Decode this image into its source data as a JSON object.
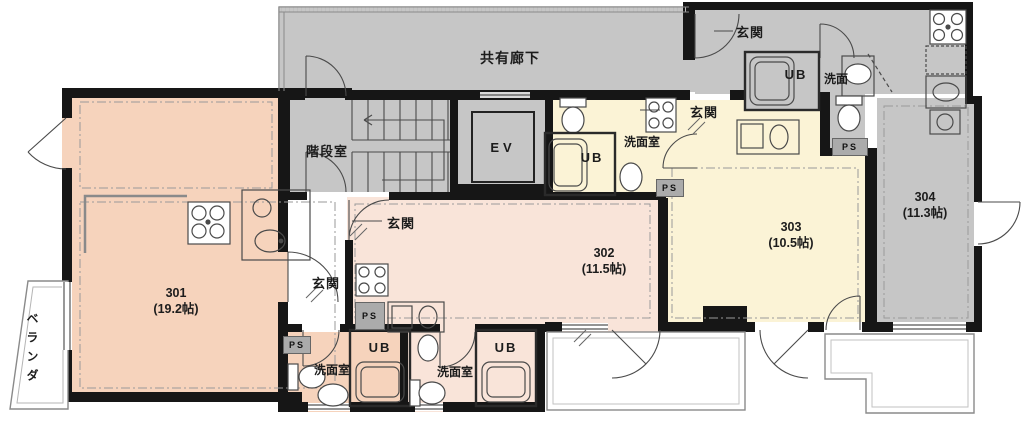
{
  "labels": {
    "corridor": "共有廊下",
    "stairwell": "階段室",
    "elevator": "EV",
    "entrance": "玄関",
    "unit_bath": "UB",
    "washroom": "洗面室",
    "basin": "洗面",
    "pipe_space": "PS",
    "veranda": "ベランダ"
  },
  "units": [
    {
      "id": "301",
      "area": "(19.2帖)"
    },
    {
      "id": "302",
      "area": "(11.5帖)"
    },
    {
      "id": "303",
      "area": "(10.5帖)"
    },
    {
      "id": "304",
      "area": "(11.3帖)"
    }
  ],
  "colors": {
    "unit301": "#f6d3bc",
    "unit302": "#f9e4d9",
    "unit303": "#fbf3d6",
    "unit304": "#c6c6c6",
    "common": "#c6c6c6",
    "wall": "#161616",
    "line": "#4a4a4a",
    "dash": "#999999",
    "ps": "#ababab"
  }
}
